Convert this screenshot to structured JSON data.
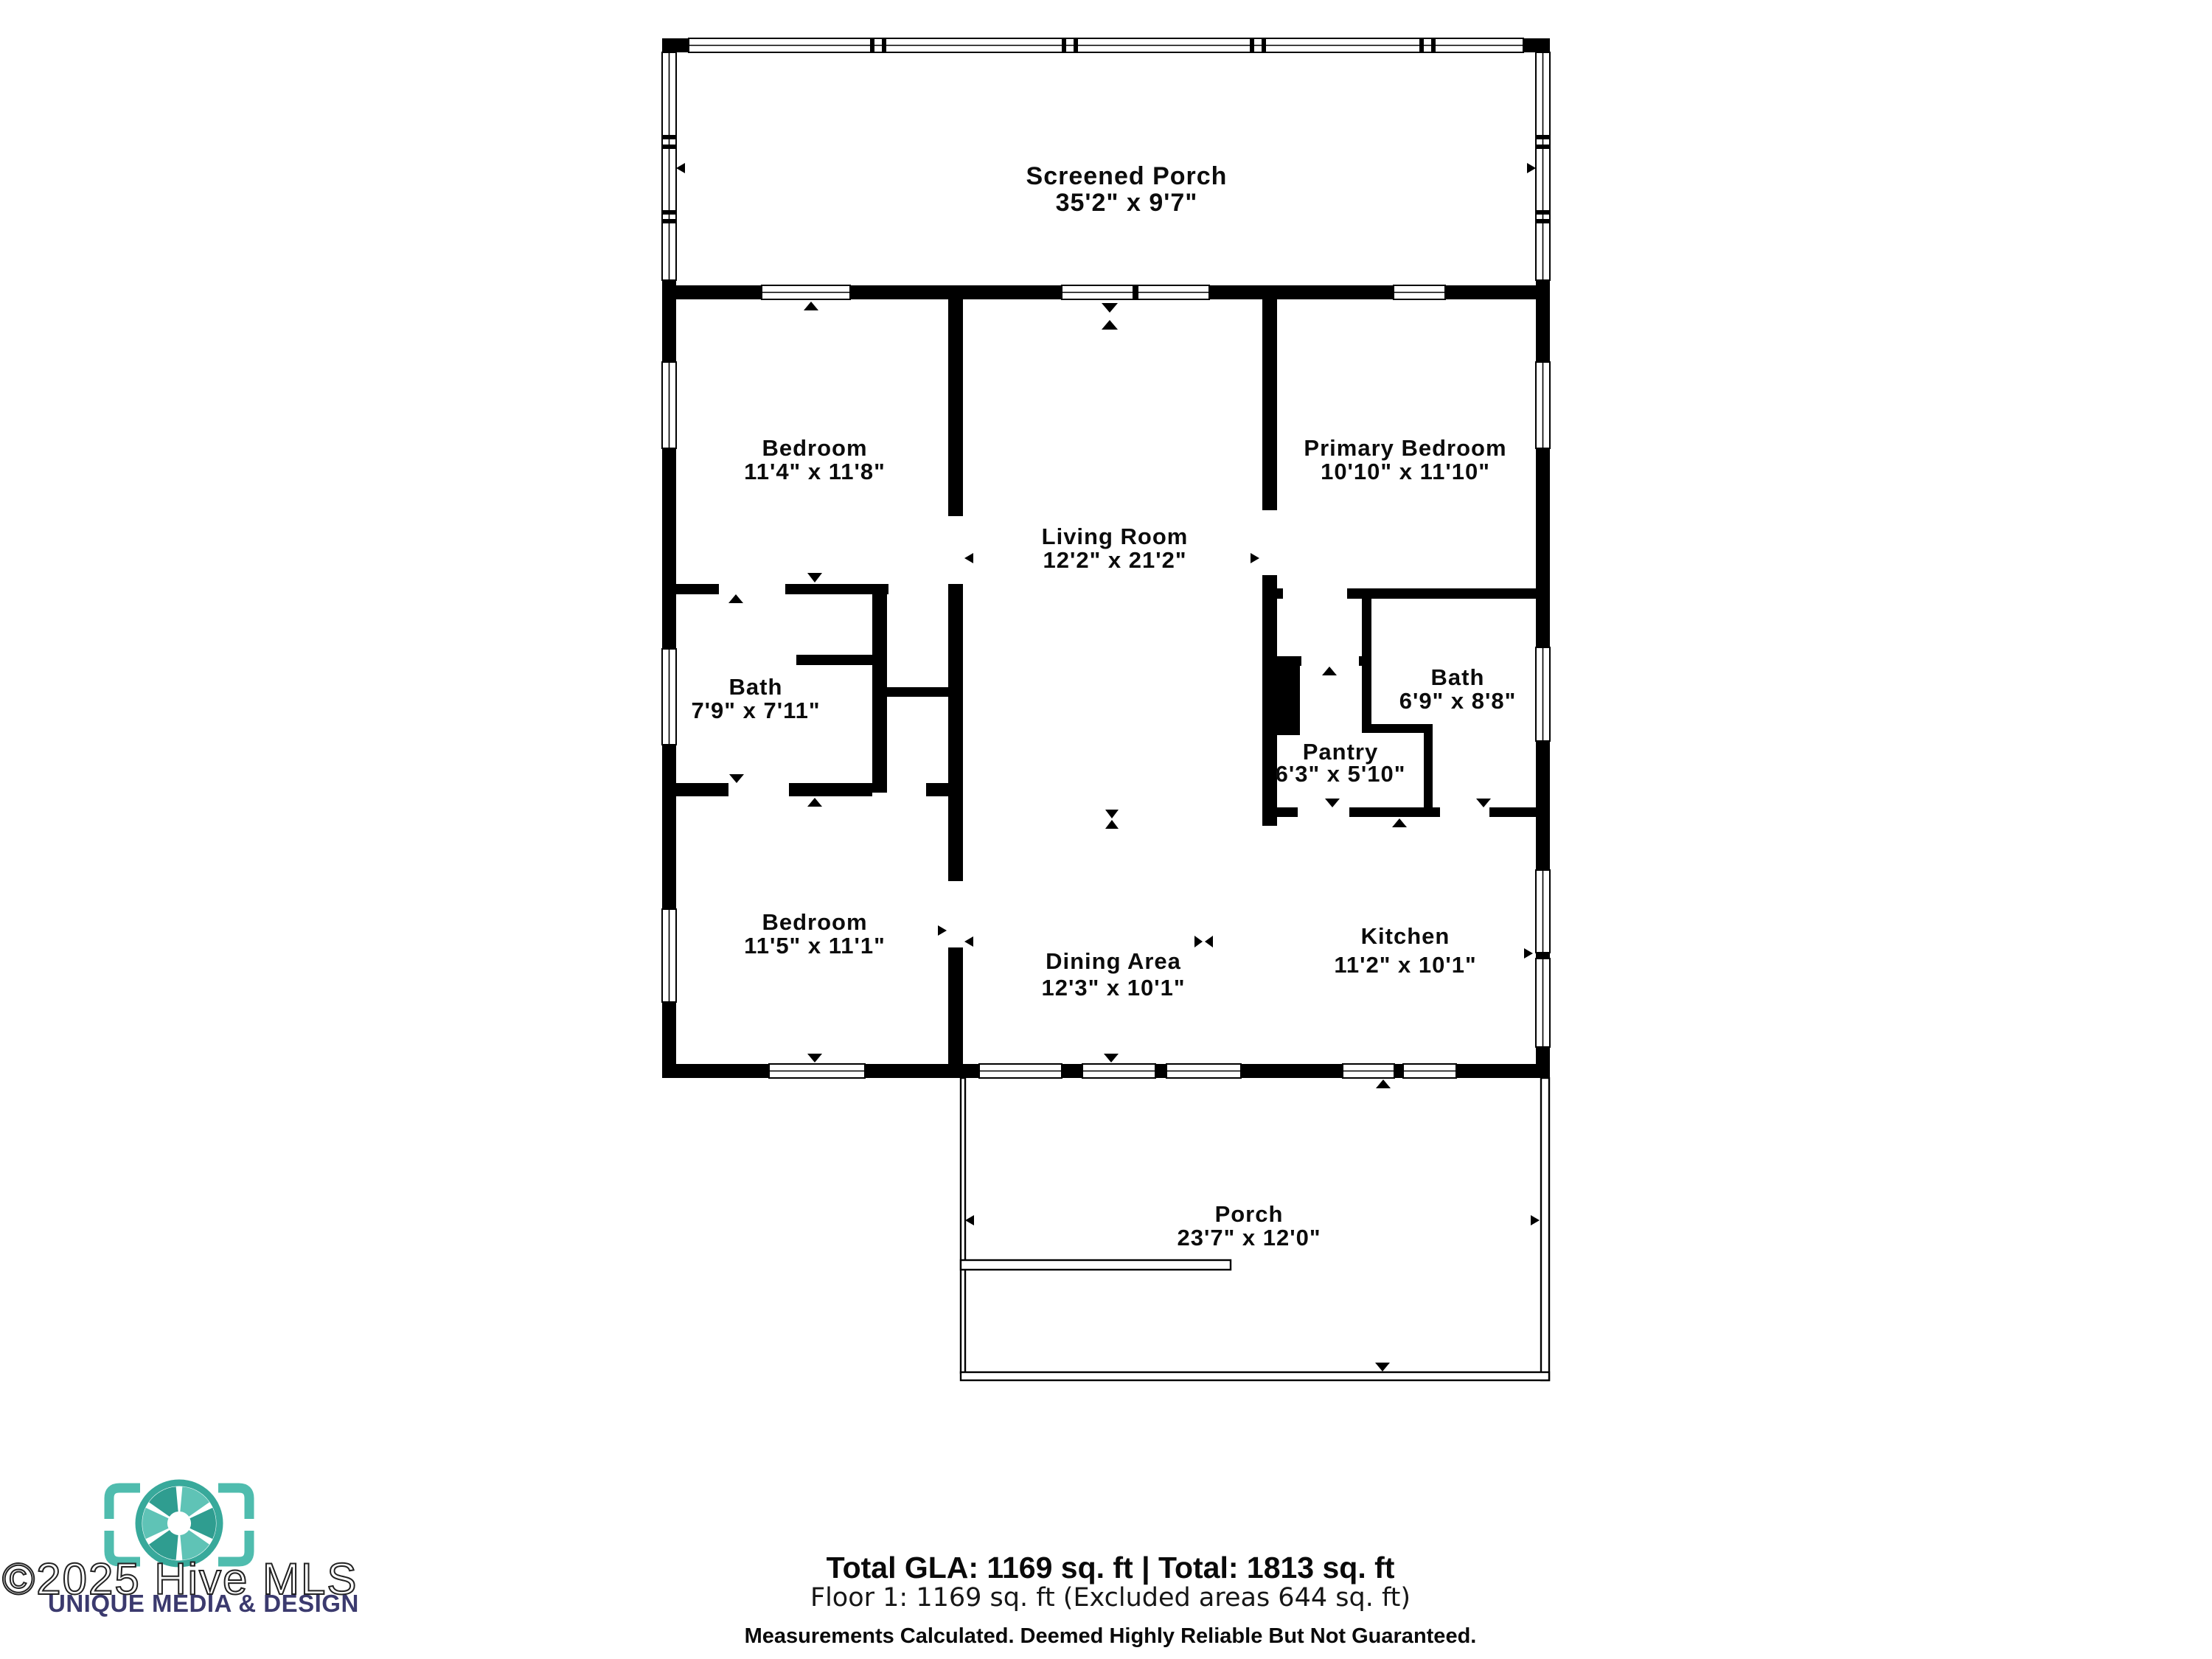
{
  "rooms": [
    {
      "name": "Screened Porch",
      "dims": "35'2\" x 9'7\""
    },
    {
      "name": "Bedroom",
      "dims": "11'4\" x 11'8\""
    },
    {
      "name": "Primary Bedroom",
      "dims": "10'10\" x 11'10\""
    },
    {
      "name": "Living Room",
      "dims": "12'2\" x 21'2\""
    },
    {
      "name": "Bath",
      "dims": "7'9\" x 7'11\""
    },
    {
      "name": "Bath",
      "dims": "6'9\" x 8'8\""
    },
    {
      "name": "Pantry",
      "dims": "6'3\" x 5'10\""
    },
    {
      "name": "Bedroom",
      "dims": "11'5\" x 11'1\""
    },
    {
      "name": "Dining Area",
      "dims": "12'3\" x 10'1\""
    },
    {
      "name": "Kitchen",
      "dims": "11'2\" x 10'1\""
    },
    {
      "name": "Porch",
      "dims": "23'7\" x 12'0\""
    }
  ],
  "footer": {
    "total_line": "Total GLA: 1169 sq. ft | Total: 1813 sq. ft",
    "floor_line": "Floor 1: 1169 sq. ft (Excluded areas 644 sq. ft)",
    "disclaimer": "Measurements Calculated. Deemed Highly Reliable But Not Guaranteed."
  },
  "watermark": {
    "copyright": "©2025 Hive MLS",
    "brand": "UNIQUE MEDIA & DESIGN",
    "logo": "camera-aperture-viewfinder-icon",
    "teal": "#4fbcae",
    "navy": "#3b3a6e"
  },
  "colors": {
    "walls": "#000000",
    "background": "#ffffff"
  }
}
